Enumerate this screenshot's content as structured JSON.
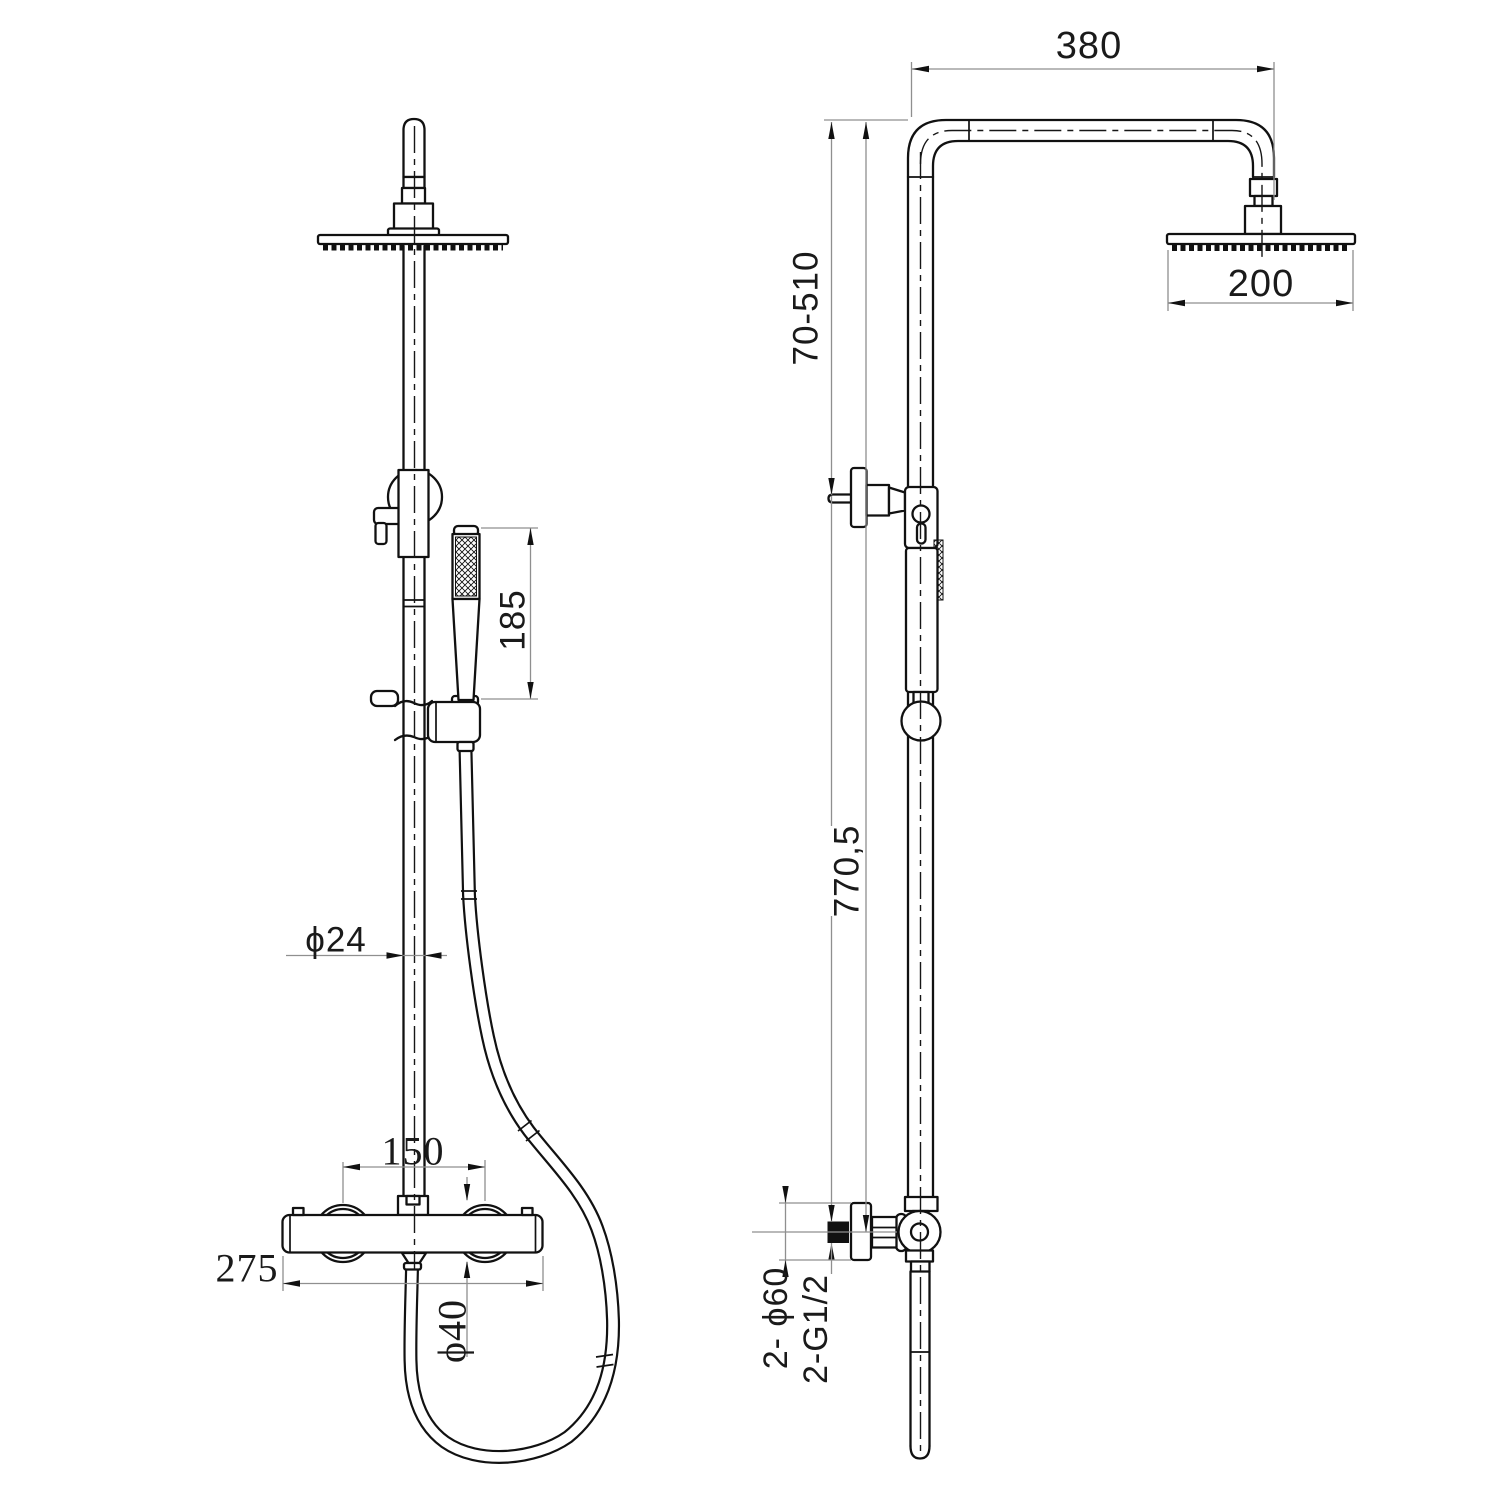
{
  "document": {
    "type": "technical-drawing",
    "subject": "Thermostatic shower column with overhead rain shower head and hand shower, two orthographic views with dimensions",
    "views": [
      "front",
      "side"
    ],
    "units": "mm"
  },
  "colors": {
    "background": "#ffffff",
    "outline": "#111111",
    "dimension_line": "#8f8f8f",
    "arrow": "#111111",
    "label": "#1a1a1a"
  },
  "front_view": {
    "dims": {
      "hand_shower_length": "185",
      "riser_diameter": "ϕ24",
      "handle_centers": "150",
      "mixer_width": "275",
      "handle_diameter": "ϕ40"
    }
  },
  "side_view": {
    "dims": {
      "arm_reach": "380",
      "head_diameter": "200",
      "height_adjust_range": "70-510",
      "column_height": "770,5",
      "wall_flange_diameter": "2- ϕ60",
      "connection_thread": "2-G1/2"
    }
  }
}
